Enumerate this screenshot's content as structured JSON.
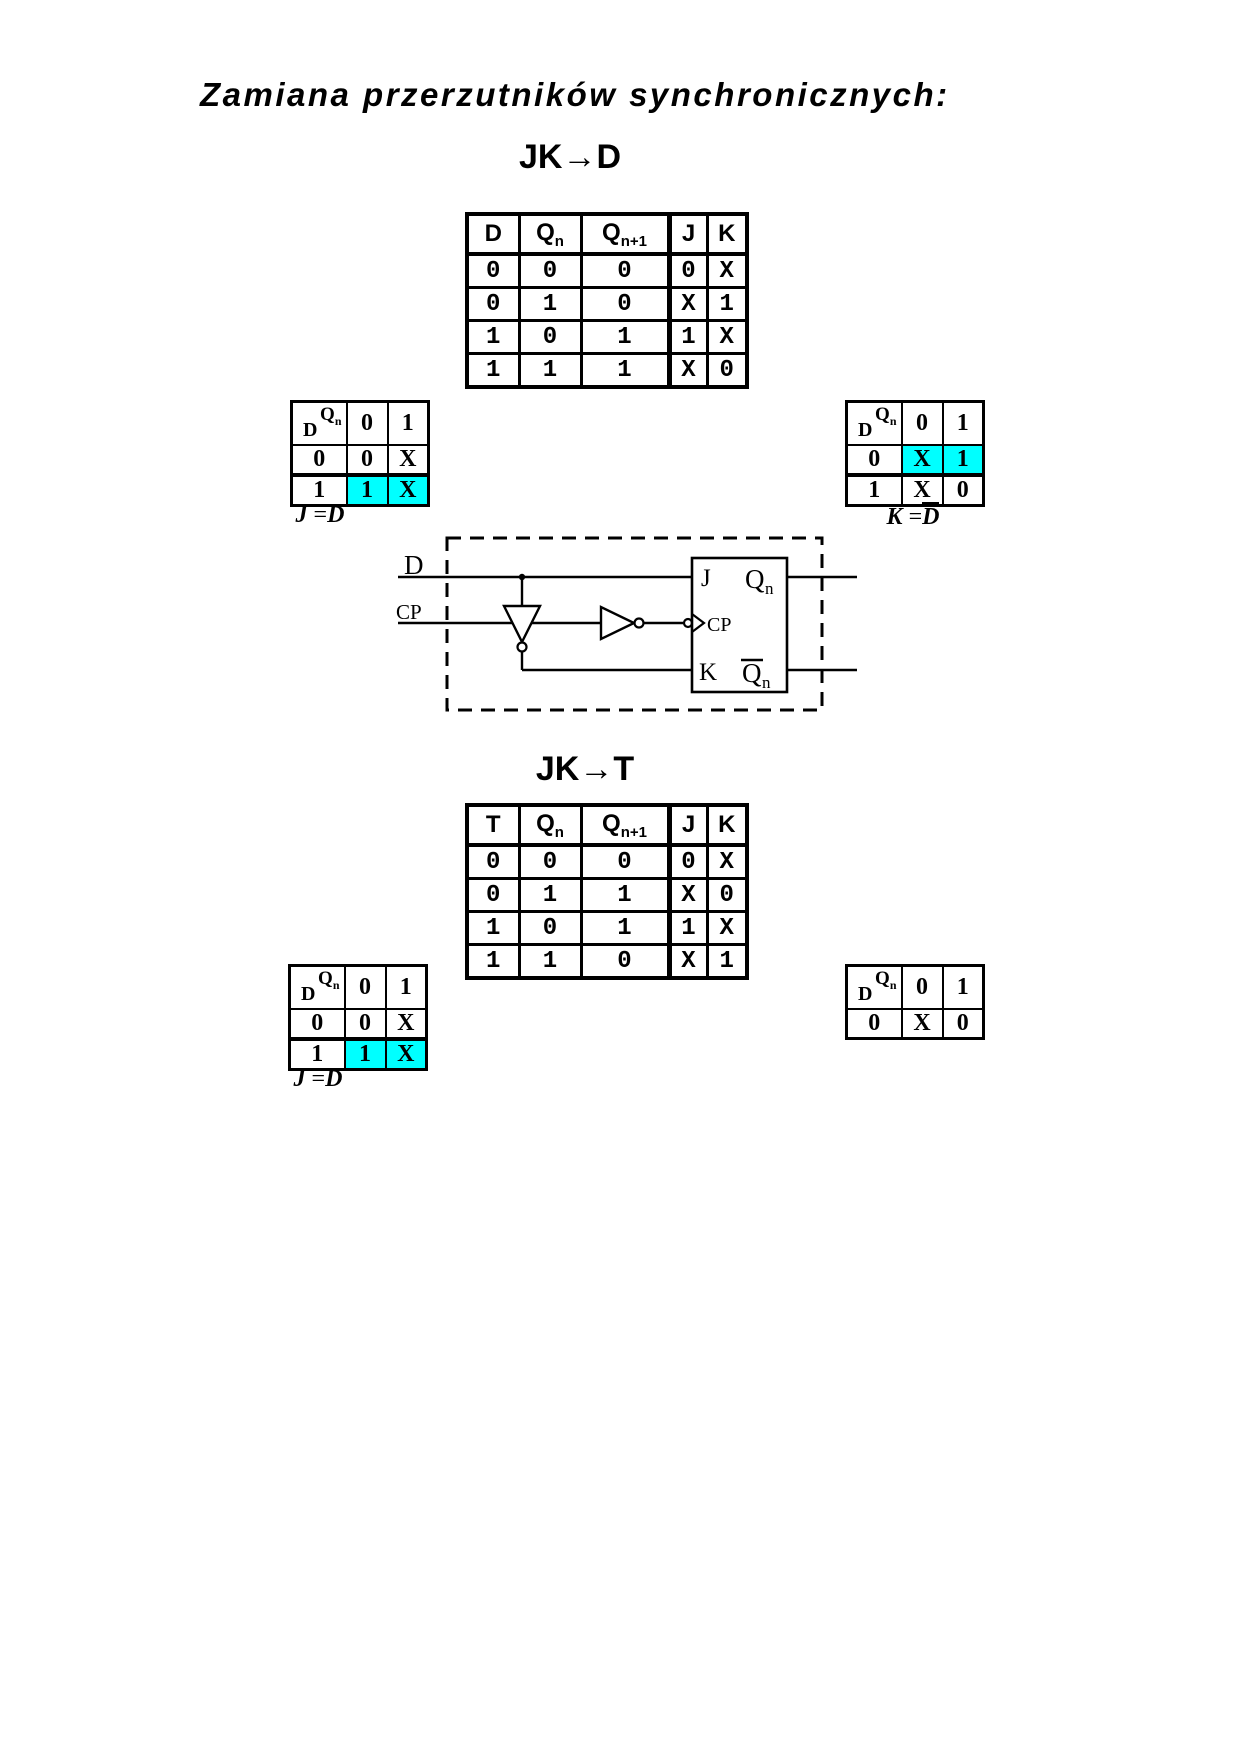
{
  "page": {
    "title": "Zamiana przerzutników synchronicznych:"
  },
  "colors": {
    "highlight": "#00ffff",
    "ink": "#000000"
  },
  "sections": [
    {
      "heading": "JK→D",
      "truth_table": {
        "headers": [
          {
            "t": "D"
          },
          {
            "t": "Q",
            "sub": "n"
          },
          {
            "t": "Q",
            "sub": "n+1"
          },
          {
            "t": "J"
          },
          {
            "t": "K"
          }
        ],
        "rows": [
          [
            "0",
            "0",
            "0",
            "0",
            "X"
          ],
          [
            "0",
            "1",
            "0",
            "X",
            "1"
          ],
          [
            "1",
            "0",
            "1",
            "1",
            "X"
          ],
          [
            "1",
            "1",
            "1",
            "X",
            "0"
          ]
        ]
      },
      "kmap_left": {
        "corner": {
          "var_top": "Q",
          "var_top_sub": "n",
          "var_side": "D"
        },
        "cols": [
          "0",
          "1"
        ],
        "rows": [
          {
            "label": "0",
            "cells": [
              "0",
              "X"
            ]
          },
          {
            "label": "1",
            "cells": [
              "1",
              "X"
            ]
          }
        ],
        "formula": {
          "lhs": "J",
          "eq": "=",
          "rhs": "D"
        }
      },
      "kmap_right": {
        "corner": {
          "var_top": "Q",
          "var_top_sub": "n",
          "var_side": "D"
        },
        "cols": [
          "0",
          "1"
        ],
        "rows": [
          {
            "label": "0",
            "cells": [
              "X",
              "1"
            ]
          },
          {
            "label": "1",
            "cells": [
              "X",
              "0"
            ]
          }
        ],
        "formula": {
          "lhs": "K",
          "eq": "=",
          "rhs": "D"
        }
      },
      "circuit": {
        "input_d": "D",
        "input_cp": "CP",
        "ff": {
          "j": "J",
          "cp": "CP",
          "k": "K",
          "q_base": "Q",
          "q_sub": "n",
          "qbar_base": "Q",
          "qbar_sub": "n"
        }
      }
    },
    {
      "heading": "JK→T",
      "truth_table": {
        "headers": [
          {
            "t": "T"
          },
          {
            "t": "Q",
            "sub": "n"
          },
          {
            "t": "Q",
            "sub": "n+1"
          },
          {
            "t": "J"
          },
          {
            "t": "K"
          }
        ],
        "rows": [
          [
            "0",
            "0",
            "0",
            "0",
            "X"
          ],
          [
            "0",
            "1",
            "1",
            "X",
            "0"
          ],
          [
            "1",
            "0",
            "1",
            "1",
            "X"
          ],
          [
            "1",
            "1",
            "0",
            "X",
            "1"
          ]
        ]
      },
      "kmap_left": {
        "corner": {
          "var_top": "Q",
          "var_top_sub": "n",
          "var_side": "D"
        },
        "cols": [
          "0",
          "1"
        ],
        "rows": [
          {
            "label": "0",
            "cells": [
              "0",
              "X"
            ]
          },
          {
            "label": "1",
            "cells": [
              "1",
              "X"
            ]
          }
        ],
        "formula": {
          "lhs": "J",
          "eq": "=",
          "rhs": "D"
        }
      },
      "kmap_right": {
        "corner": {
          "var_top": "Q",
          "var_top_sub": "n",
          "var_side": "D"
        },
        "cols": [
          "0",
          "1"
        ],
        "rows": [
          {
            "label": "0",
            "cells": [
              "X",
              "0"
            ]
          }
        ]
      }
    }
  ]
}
